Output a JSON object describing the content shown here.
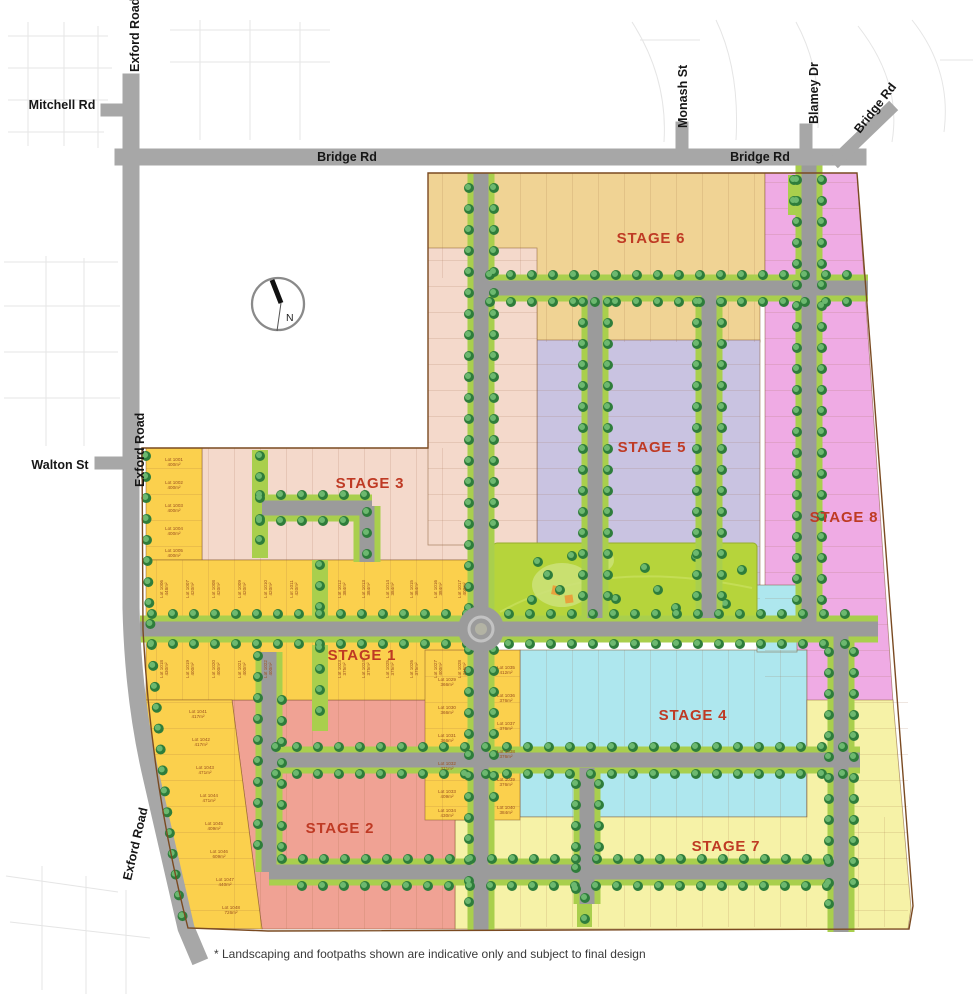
{
  "map": {
    "road_labels": [
      {
        "id": "exford-top",
        "text": "Exford Road"
      },
      {
        "id": "mitchell",
        "text": "Mitchell Rd"
      },
      {
        "id": "bridge-main",
        "text": "Bridge Rd"
      },
      {
        "id": "monash",
        "text": "Monash St"
      },
      {
        "id": "blamey",
        "text": "Blamey Dr"
      },
      {
        "id": "bridge-east",
        "text": "Bridge Rd"
      },
      {
        "id": "bridge-diagonal",
        "text": "Bridge Rd"
      },
      {
        "id": "walton",
        "text": "Walton St"
      },
      {
        "id": "exford-mid",
        "text": "Exford Road"
      },
      {
        "id": "exford-bottom",
        "text": "Exford Road"
      }
    ],
    "stages": [
      {
        "label": "STAGE 1"
      },
      {
        "label": "STAGE 2"
      },
      {
        "label": "STAGE 3"
      },
      {
        "label": "STAGE 4"
      },
      {
        "label": "STAGE 5"
      },
      {
        "label": "STAGE 6"
      },
      {
        "label": "STAGE 7"
      },
      {
        "label": "STAGE 8"
      }
    ],
    "compass": {
      "north": "N"
    },
    "footnote": "* Landscaping and footpaths shown are indicative only and subject to final design",
    "colors": {
      "stage1": "#fbd04d",
      "stage2": "#f0a294",
      "stage3": "#f4d9cb",
      "stage4": "#aee7ee",
      "stage5": "#c9c3e1",
      "stage6": "#f0d394",
      "stage7": "#f6f2a7",
      "stage8": "#efabe4",
      "park": "#b6d43b",
      "road": "#9b9b9b",
      "verge": "#a9cf4d",
      "tree": "#2e7d3b",
      "stage_label": "#bf3a24",
      "boundary": "#7a4a21"
    },
    "lots": [
      {
        "lot": "Lot 1001",
        "area": "400m²",
        "x": 174,
        "y": 461,
        "r": 0
      },
      {
        "lot": "Lot 1002",
        "area": "400m²",
        "x": 174,
        "y": 484,
        "r": 0
      },
      {
        "lot": "Lot 1003",
        "area": "400m²",
        "x": 174,
        "y": 507,
        "r": 0
      },
      {
        "lot": "Lot 1004",
        "area": "400m²",
        "x": 174,
        "y": 530,
        "r": 0
      },
      {
        "lot": "Lot 1005",
        "area": "400m²",
        "x": 174,
        "y": 552,
        "r": 0
      },
      {
        "lot": "Lot 1006",
        "area": "448m²",
        "x": 163,
        "y": 589,
        "r": -90
      },
      {
        "lot": "Lot 1007",
        "area": "420m²",
        "x": 189,
        "y": 589,
        "r": -90
      },
      {
        "lot": "Lot 1008",
        "area": "420m²",
        "x": 215,
        "y": 589,
        "r": -90
      },
      {
        "lot": "Lot 1009",
        "area": "420m²",
        "x": 241,
        "y": 589,
        "r": -90
      },
      {
        "lot": "Lot 1010",
        "area": "420m²",
        "x": 267,
        "y": 589,
        "r": -90
      },
      {
        "lot": "Lot 1011",
        "area": "420m²",
        "x": 293,
        "y": 589,
        "r": -90
      },
      {
        "lot": "Lot 1012",
        "area": "384m²",
        "x": 341,
        "y": 589,
        "r": -90
      },
      {
        "lot": "Lot 1013",
        "area": "384m²",
        "x": 365,
        "y": 589,
        "r": -90
      },
      {
        "lot": "Lot 1014",
        "area": "384m²",
        "x": 389,
        "y": 589,
        "r": -90
      },
      {
        "lot": "Lot 1015",
        "area": "384m²",
        "x": 413,
        "y": 589,
        "r": -90
      },
      {
        "lot": "Lot 1016",
        "area": "384m²",
        "x": 437,
        "y": 589,
        "r": -90
      },
      {
        "lot": "Lot 1017",
        "area": "400m²",
        "x": 461,
        "y": 589,
        "r": -90
      },
      {
        "lot": "Lot 1018",
        "area": "430m²",
        "x": 163,
        "y": 669,
        "r": -90
      },
      {
        "lot": "Lot 1019",
        "area": "400m²",
        "x": 189,
        "y": 669,
        "r": -90
      },
      {
        "lot": "Lot 1020",
        "area": "400m²",
        "x": 215,
        "y": 669,
        "r": -90
      },
      {
        "lot": "Lot 1021",
        "area": "400m²",
        "x": 241,
        "y": 669,
        "r": -90
      },
      {
        "lot": "Lot 1022",
        "area": "400m²",
        "x": 267,
        "y": 669,
        "r": -90
      },
      {
        "lot": "Lot 1023",
        "area": "375m²",
        "x": 341,
        "y": 669,
        "r": -90
      },
      {
        "lot": "Lot 1024",
        "area": "375m²",
        "x": 365,
        "y": 669,
        "r": -90
      },
      {
        "lot": "Lot 1025",
        "area": "375m²",
        "x": 389,
        "y": 669,
        "r": -90
      },
      {
        "lot": "Lot 1026",
        "area": "375m²",
        "x": 413,
        "y": 669,
        "r": -90
      },
      {
        "lot": "Lot 1027",
        "area": "400m²",
        "x": 437,
        "y": 669,
        "r": -90
      },
      {
        "lot": "Lot 1028",
        "area": "416m²",
        "x": 461,
        "y": 669,
        "r": -90
      },
      {
        "lot": "Lot 1029",
        "area": "366m²",
        "x": 447,
        "y": 681,
        "r": 0
      },
      {
        "lot": "Lot 1030",
        "area": "366m²",
        "x": 447,
        "y": 709,
        "r": 0
      },
      {
        "lot": "Lot 1031",
        "area": "366m²",
        "x": 447,
        "y": 737,
        "r": 0
      },
      {
        "lot": "Lot 1032",
        "area": "371m²",
        "x": 447,
        "y": 765,
        "r": 0
      },
      {
        "lot": "Lot 1033",
        "area": "409m²",
        "x": 447,
        "y": 793,
        "r": 0
      },
      {
        "lot": "Lot 1034",
        "area": "430m²",
        "x": 447,
        "y": 812,
        "r": 0
      },
      {
        "lot": "Lot 1035",
        "area": "412m²",
        "x": 506,
        "y": 669,
        "r": 0
      },
      {
        "lot": "Lot 1036",
        "area": "376m²",
        "x": 506,
        "y": 697,
        "r": 0
      },
      {
        "lot": "Lot 1037",
        "area": "376m²",
        "x": 506,
        "y": 725,
        "r": 0
      },
      {
        "lot": "Lot 1038",
        "area": "376m²",
        "x": 506,
        "y": 753,
        "r": 0
      },
      {
        "lot": "Lot 1039",
        "area": "376m²",
        "x": 506,
        "y": 781,
        "r": 0
      },
      {
        "lot": "Lot 1040",
        "area": "384m²",
        "x": 506,
        "y": 809,
        "r": 0
      },
      {
        "lot": "Lot 1041",
        "area": "417m²",
        "x": 198,
        "y": 713,
        "r": 0
      },
      {
        "lot": "Lot 1042",
        "area": "417m²",
        "x": 201,
        "y": 741,
        "r": 0
      },
      {
        "lot": "Lot 1043",
        "area": "471m²",
        "x": 205,
        "y": 769,
        "r": 0
      },
      {
        "lot": "Lot 1044",
        "area": "471m²",
        "x": 209,
        "y": 797,
        "r": 0
      },
      {
        "lot": "Lot 1045",
        "area": "409m²",
        "x": 214,
        "y": 825,
        "r": 0
      },
      {
        "lot": "Lot 1046",
        "area": "609m²",
        "x": 219,
        "y": 853,
        "r": 0
      },
      {
        "lot": "Lot 1047",
        "area": "440m²",
        "x": 225,
        "y": 881,
        "r": 0
      },
      {
        "lot": "Lot 1048",
        "area": "726m²",
        "x": 231,
        "y": 909,
        "r": 0
      }
    ]
  }
}
